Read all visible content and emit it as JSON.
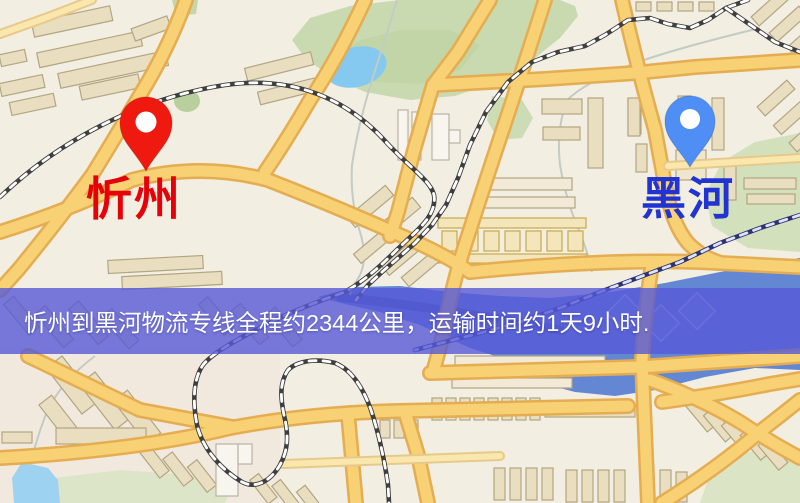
{
  "map": {
    "origin": {
      "label": "忻州"
    },
    "destination": {
      "label": "黑河"
    },
    "banner": {
      "text": "忻州到黑河物流专线全程约2344公里，运输时间约1天9小时.",
      "distance_text": "2344公里",
      "duration_text": "1天9小时"
    },
    "colors": {
      "origin_pin": "#f0190f",
      "destination_pin": "#4f8ef5",
      "origin_label": "#e60008",
      "destination_label": "#2134d3",
      "banner_bg": "#5659d7",
      "road_fill": "#f7d173",
      "water_light": "#85c9f0",
      "water_river": "#6487d4",
      "park_green": "#c9dab0"
    }
  }
}
